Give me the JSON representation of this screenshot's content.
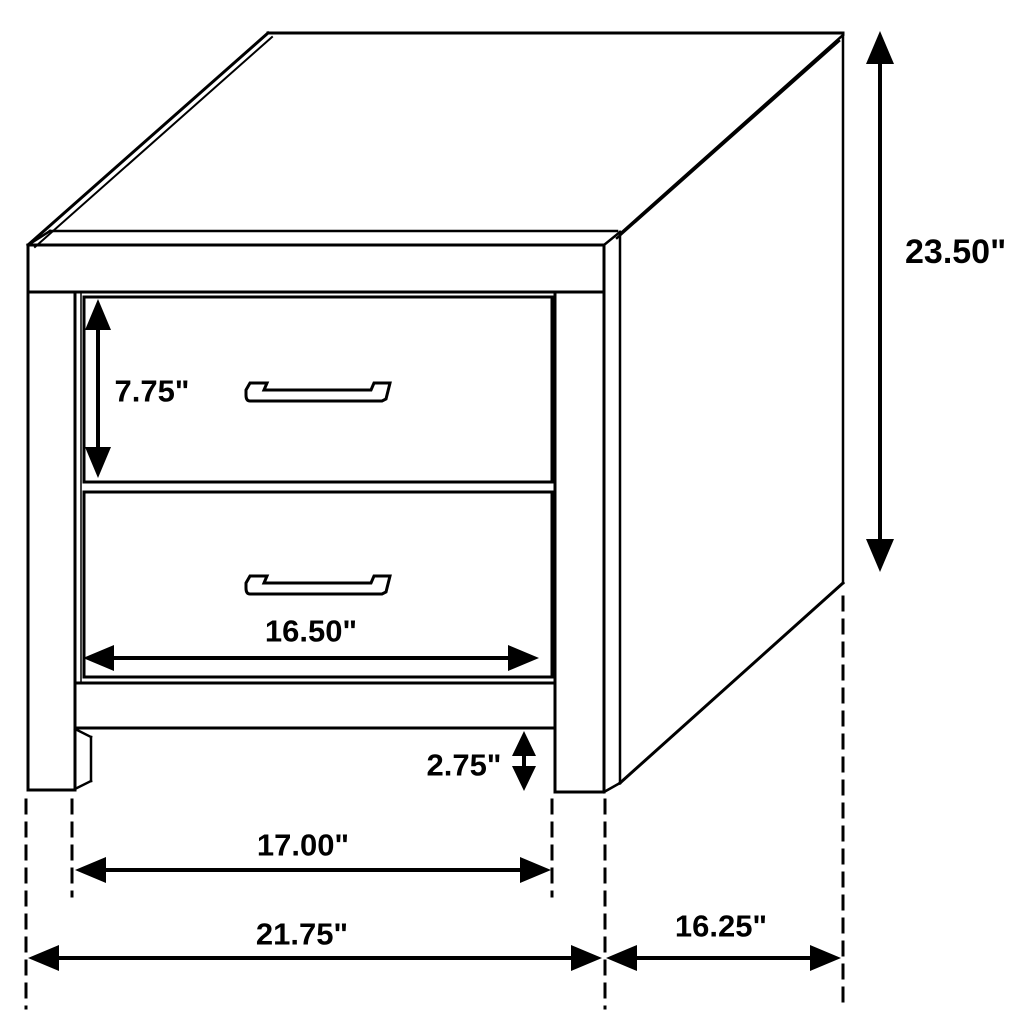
{
  "figure": {
    "subject": "2-drawer nightstand dimension line drawing",
    "background_color": "#ffffff",
    "line_color": "#000000",
    "units": "inches"
  },
  "dimensions": {
    "overall_height": {
      "label": "23.50\"",
      "value": 23.5
    },
    "top_drawer_height": {
      "label": "7.75\"",
      "value": 7.75
    },
    "drawer_width": {
      "label": "16.50\"",
      "value": 16.5
    },
    "leg_height": {
      "label": "2.75\"",
      "value": 2.75
    },
    "leg_span_width": {
      "label": "17.00\"",
      "value": 17.0
    },
    "overall_width": {
      "label": "21.75\"",
      "value": 21.75
    },
    "overall_depth": {
      "label": "16.25\"",
      "value": 16.25
    }
  }
}
